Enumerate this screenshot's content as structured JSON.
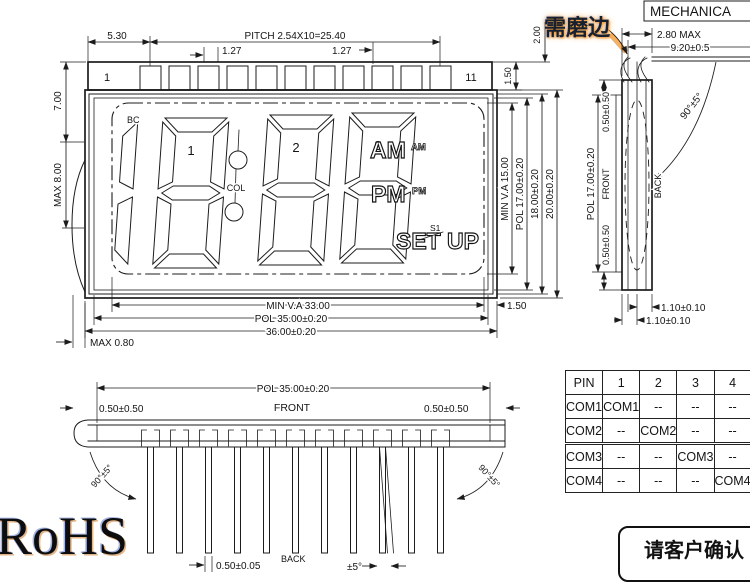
{
  "front_view": {
    "pin_count": 11,
    "pin_first": "1",
    "pin_last": "11",
    "dims": {
      "d530": "5.30",
      "pitch": "PITCH 2.54X10=25.40",
      "p127l": "1.27",
      "p127r": "1.27",
      "d700": "7.00",
      "max800": "MAX 8.00",
      "d150top": "1.50",
      "d200": "2.00",
      "minva15": "MIN V.A 15.00",
      "pol17": "POL 17.00±0.20",
      "d18": "18.00±0.20",
      "d20": "20.00±0.20",
      "minva33": "MIN V.A 33.00",
      "pol35": "POL 35.00±0.20",
      "d36": "36.00±0.20",
      "max080": "MAX 0.80",
      "d150right": "1.50"
    },
    "lcd": {
      "bc": "BC",
      "col": "COL",
      "digits": [
        "1",
        "2",
        "3"
      ],
      "am": "AM",
      "am_small": "AM",
      "pm": "PM",
      "pm_small": "PM",
      "set": "SET",
      "up": "UP",
      "s1": "S1"
    }
  },
  "side_view": {
    "title": "MECHANICA",
    "grind_note": "需磨边",
    "dims": {
      "max280": "2.80 MAX",
      "d920": "9.20±0.5",
      "angle": "90°±5°",
      "pol17": "POL 17.00±0.20",
      "off_top": "0.50±0.50",
      "front": "FRONT",
      "off_bottom": "0.50±0.50",
      "back": "BACK",
      "d110a": "1.10±0.10",
      "d110b": "1.10±0.10"
    }
  },
  "bottom_view": {
    "dims": {
      "pol35": "POL 35.00±0.20",
      "off_left": "0.50±0.50",
      "front": "FRONT",
      "off_right": "0.50±0.50",
      "angle_left": "90°±5°",
      "angle_right": "90°±5°",
      "pin_thick": "0.50±0.05",
      "back": "BACK",
      "tilt": "±5°"
    }
  },
  "pin_table": {
    "header": [
      "PIN",
      "1",
      "2",
      "3",
      "4"
    ],
    "rows": [
      [
        "COM1",
        "COM1",
        "--",
        "--",
        "--"
      ],
      [
        "COM2",
        "--",
        "COM2",
        "--",
        "--"
      ],
      [
        "COM3",
        "--",
        "--",
        "COM3",
        "--"
      ],
      [
        "COM4",
        "--",
        "--",
        "--",
        "COM4"
      ]
    ]
  },
  "footer": {
    "rohs": "RoHS",
    "confirm_note": "请客户确认"
  },
  "colors": {
    "line": "#1c1c1c",
    "highlight": "#f0a030"
  }
}
